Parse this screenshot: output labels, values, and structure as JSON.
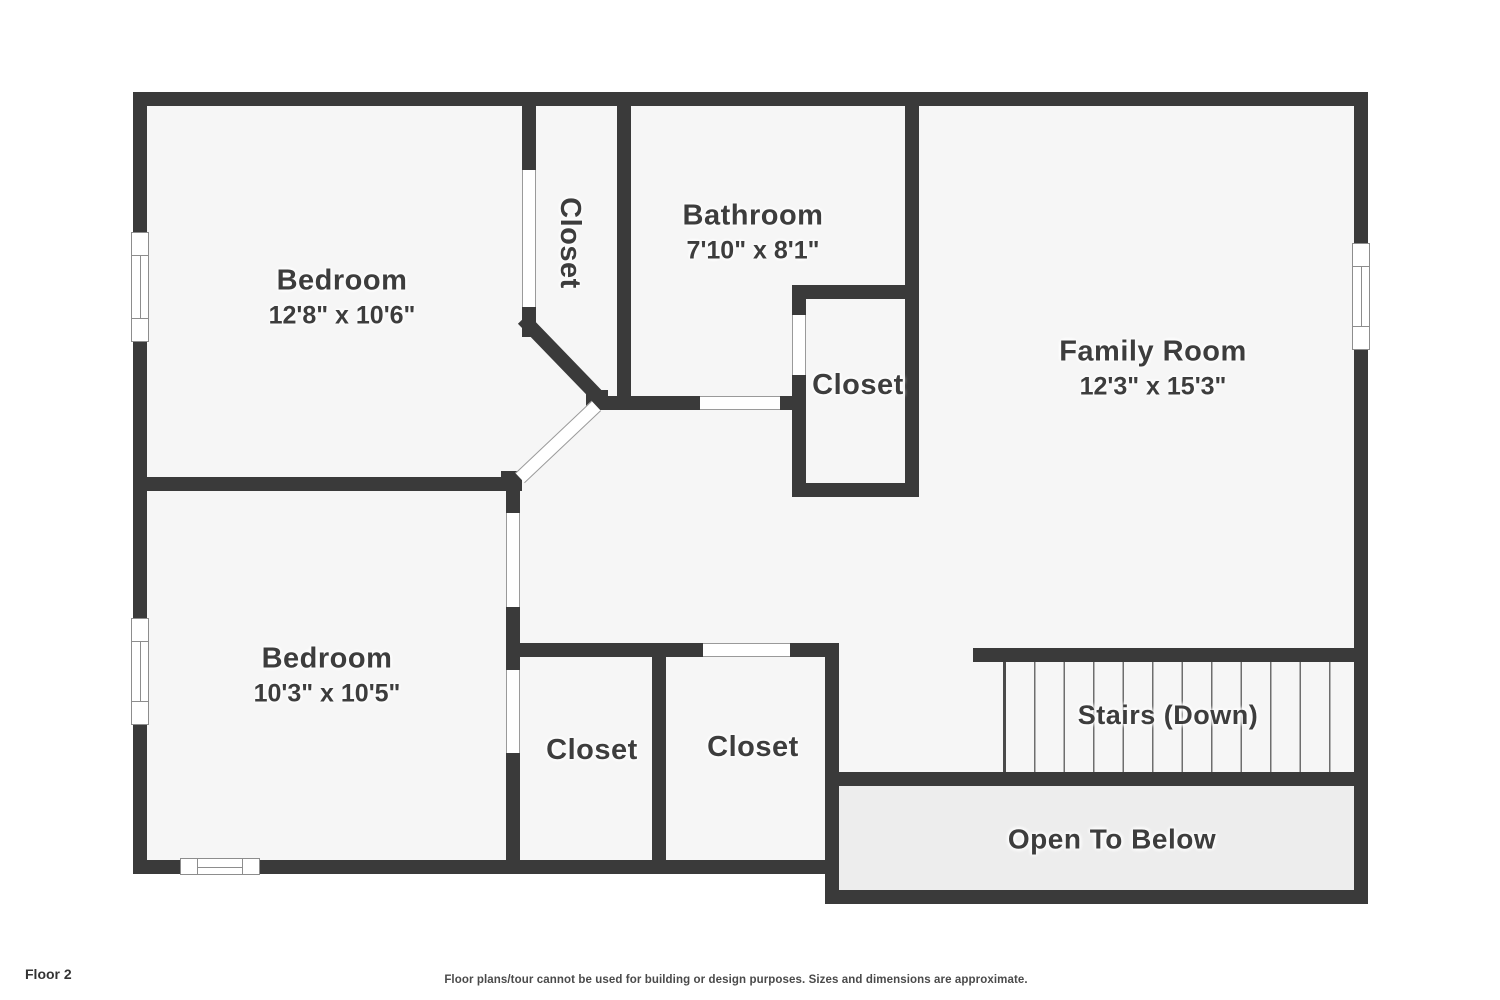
{
  "title": "Floor 2 floor plan",
  "colors": {
    "wall": "#3a3a3a",
    "floor": "#f6f6f6",
    "open_floor": "#ededed",
    "door_line": "#9a9a9a",
    "text": "#3d3d3d",
    "background": "#ffffff",
    "tread": "#6e6e6e"
  },
  "rooms": {
    "bedroom1": {
      "name": "Bedroom",
      "dims": "12'8\" x 10'6\""
    },
    "closet_top": {
      "name": "Closet"
    },
    "bathroom": {
      "name": "Bathroom",
      "dims": "7'10\" x 8'1\""
    },
    "family_room": {
      "name": "Family Room",
      "dims": "12'3\" x 15'3\""
    },
    "closet_bath": {
      "name": "Closet"
    },
    "bedroom2": {
      "name": "Bedroom",
      "dims": "10'3\" x 10'5\""
    },
    "closet_b1": {
      "name": "Closet"
    },
    "closet_b2": {
      "name": "Closet"
    },
    "stairs": {
      "name": "Stairs (Down)"
    },
    "open_below": {
      "name": "Open To Below"
    }
  },
  "footer": {
    "floor_label": "Floor 2",
    "disclaimer": "Floor plans/tour cannot be used for building or design purposes. Sizes and dimensions are approximate."
  }
}
